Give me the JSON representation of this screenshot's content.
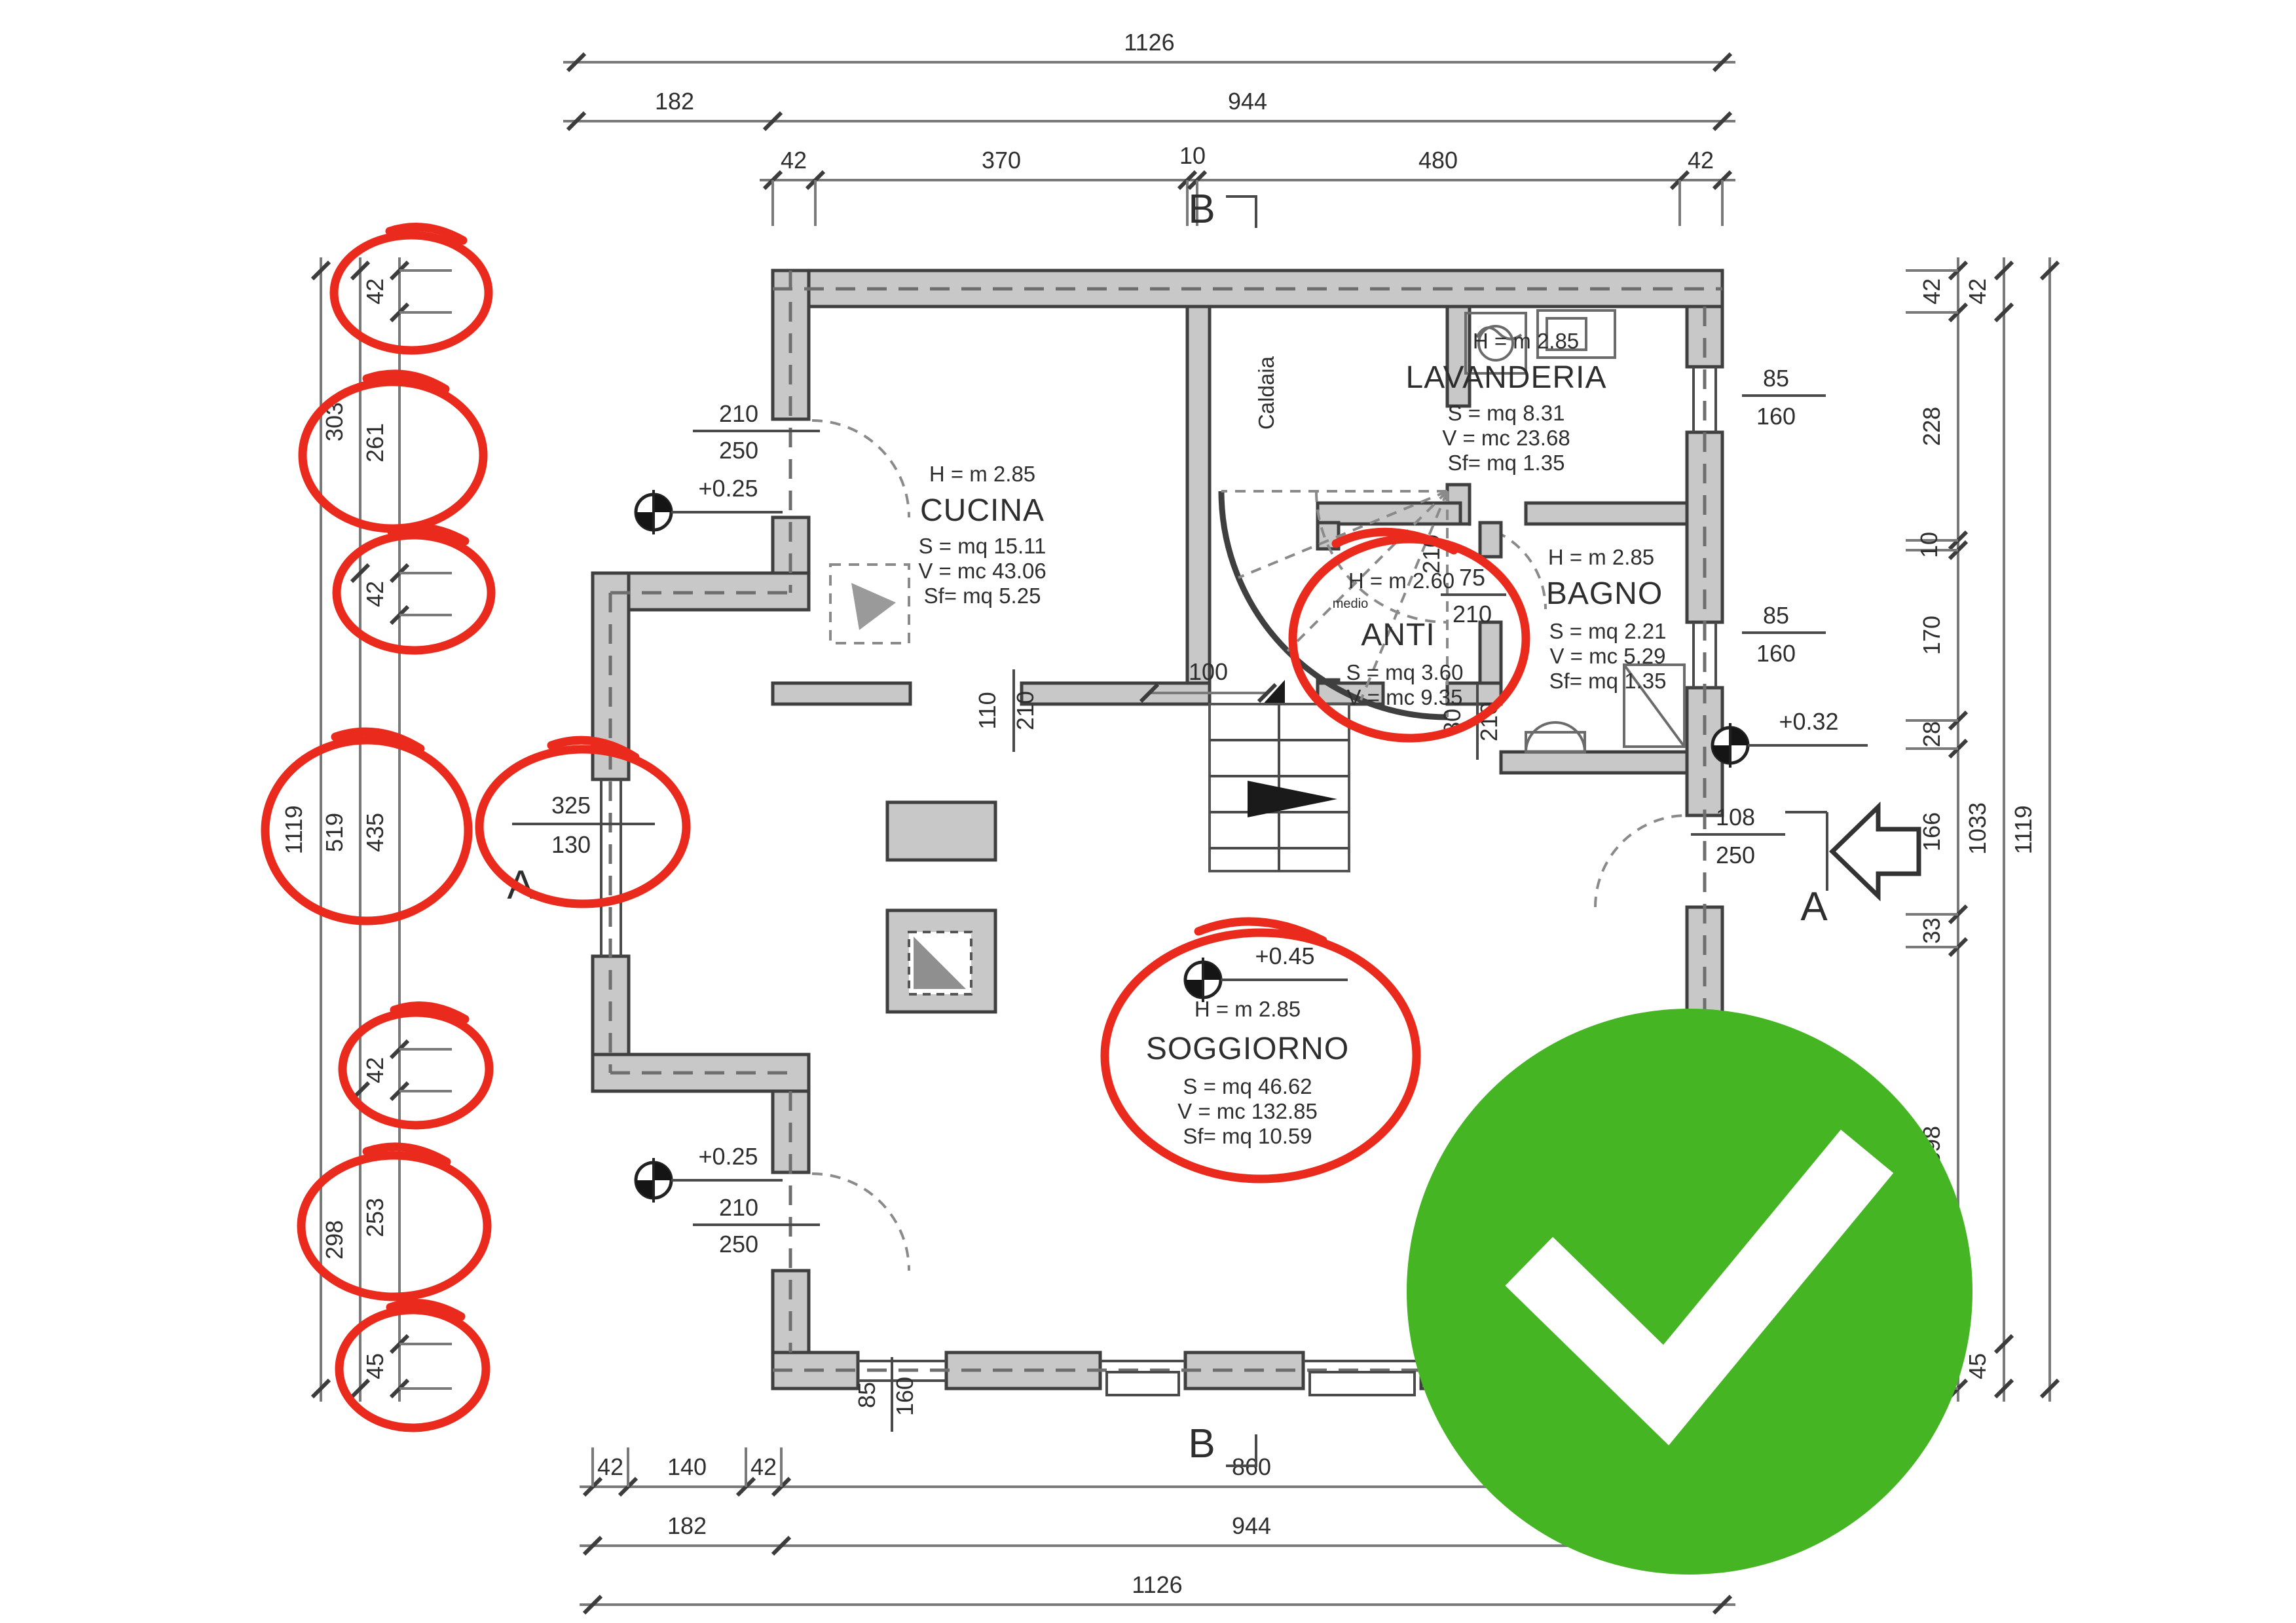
{
  "meta": {
    "drawing_type": "architectural floor plan",
    "check_color": "#45b524",
    "annotation_color": "#ea2a1c"
  },
  "dims": {
    "top": {
      "total": "1126",
      "row2": [
        "182",
        "944"
      ],
      "row3": [
        "42",
        "370",
        "10",
        "480",
        "42"
      ]
    },
    "bottom": {
      "row1": [
        "42",
        "140",
        "42",
        "860"
      ],
      "row2": [
        "182",
        "944"
      ],
      "total": "1126"
    },
    "left": {
      "outer": "1119",
      "middle": [
        "303",
        "519",
        "298"
      ],
      "inner": [
        "42",
        "261",
        "42",
        "435",
        "42",
        "253",
        "45"
      ]
    },
    "right": {
      "inner": [
        "42",
        "228",
        "10",
        "170",
        "28",
        "166",
        "33",
        "398",
        "45"
      ],
      "middle": [
        "42",
        "1033",
        "45"
      ],
      "outer": "1119"
    }
  },
  "rooms": {
    "cucina": {
      "h": "H = m    2.85",
      "name": "CUCINA",
      "s": "S = mq 15.11",
      "v": "V = mc 43.06",
      "sf": "Sf= mq   5.25"
    },
    "lavanderia": {
      "h": "H = m    2.85",
      "name": "LAVANDERIA",
      "s": "S = mq   8.31",
      "v": "V = mc 23.68",
      "sf": "Sf= mq   1.35"
    },
    "anti": {
      "h": "H = m    2.60",
      "note": "medio",
      "name": "ANTI",
      "s": "S = mq   3.60",
      "v": "V = mc   9.35"
    },
    "bagno": {
      "h": "H = m    2.85",
      "name": "BAGNO",
      "s": "S = mq   2.21",
      "v": "V = mc   5.29",
      "sf": "Sf= mq   1.35"
    },
    "soggiorno": {
      "h": "H = m    2.85",
      "name": "SOGGIORNO",
      "s": "S = mq 46.62",
      "v": "V = mc 132.85",
      "sf": "Sf= mq 10.59"
    },
    "caldaia_label": "Caldaia"
  },
  "levels": {
    "upper_left": "+0.25",
    "lower_left": "+0.25",
    "right": "+0.32",
    "soggiorno": "+0.45"
  },
  "markers": {
    "top_b": "B",
    "bottom_b": "B",
    "left_a": "A",
    "right_a": "A"
  },
  "openings": {
    "door_upper_left": [
      "210",
      "250"
    ],
    "door_lower_left": [
      "210",
      "250"
    ],
    "left_detail": [
      "325",
      "130"
    ],
    "cucina_passage": [
      "110",
      "210"
    ],
    "stair_landing": "100",
    "anti_side": "210",
    "anti_passage": [
      "80",
      "210"
    ],
    "bagno_door": [
      "75",
      "210"
    ],
    "entry_door": [
      "108",
      "250"
    ],
    "window_right_upper": [
      "85",
      "160"
    ],
    "window_right_lower": [
      "85",
      "160"
    ],
    "window_bottom": [
      "85",
      "160"
    ]
  }
}
